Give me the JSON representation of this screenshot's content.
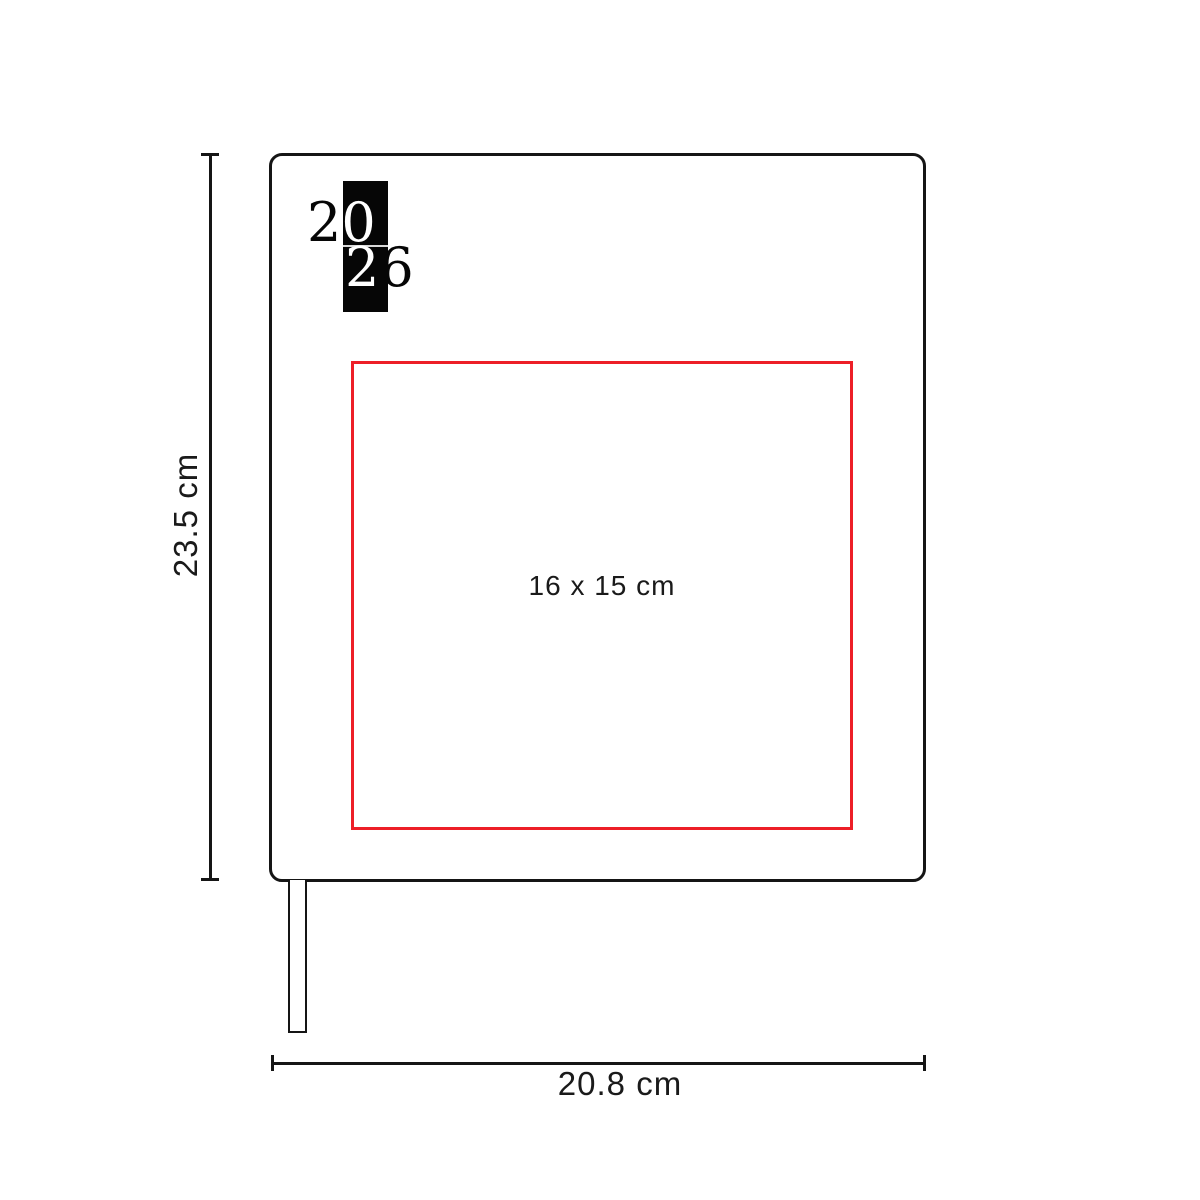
{
  "diagram": {
    "product": "2026 agenda / notebook dimension diagram",
    "logo": {
      "row1_left_digit": "2",
      "row1_right_digit": "0",
      "row2_left_digit": "2",
      "row2_right_digit": "6",
      "block_color": "#060606"
    },
    "print_area": {
      "label": "16 x 15 cm",
      "border_color": "#ed1f28"
    },
    "dimensions": {
      "height_label": "23.5 cm",
      "width_label": "20.8 cm"
    },
    "colors": {
      "line_black": "#151515",
      "text_dark": "#1a1a1a",
      "accent_red": "#ed1f28",
      "background": "#ffffff"
    }
  }
}
